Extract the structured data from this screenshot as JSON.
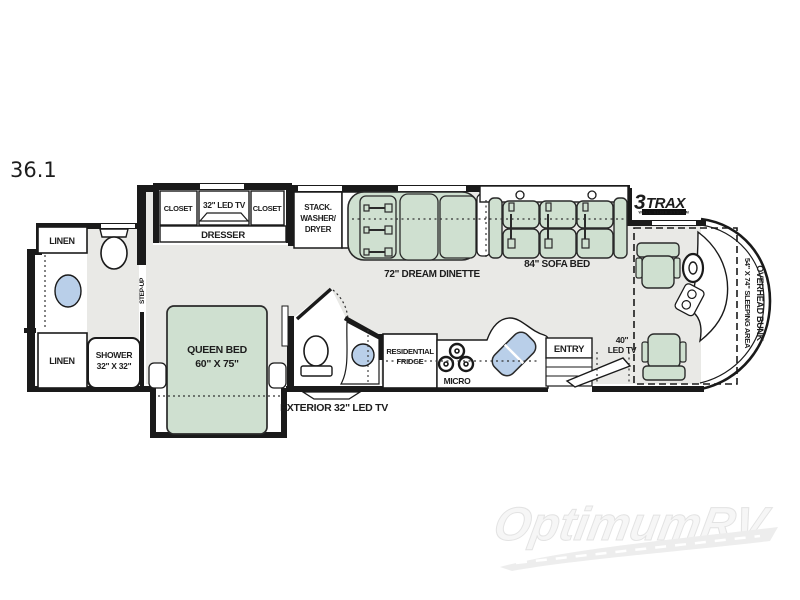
{
  "model": "36.1",
  "brand_logo": {
    "prefix": "3",
    "name": "TRAX",
    "tagline": "WALL SLIDE SYSTEM",
    "blue": "#1b9cd8",
    "dark": "#0d2b4a"
  },
  "watermark": "OptimumRV",
  "labels": {
    "linen_top": "LINEN",
    "linen_bottom": "LINEN",
    "step_up": "STEP-UP",
    "shower": "SHOWER",
    "shower_size": "32\" X 32\"",
    "closet_left": "CLOSET",
    "closet_right": "CLOSET",
    "bedroom_tv": "32\" LED TV",
    "dresser": "DRESSER",
    "washer_line1": "STACK.",
    "washer_line2": "WASHER/",
    "washer_line3": "DRYER",
    "pantry": "PANTRY",
    "dinette": "72\" DREAM DINETTE",
    "sofa": "84\" SOFA BED",
    "queen_bed": "QUEEN BED",
    "queen_size": "60\" X 75\"",
    "exterior_tv": "EXTERIOR 32\" LED TV",
    "fridge_line1": "RESIDENTIAL",
    "fridge_line2": "FRIDGE",
    "micro": "MICRO",
    "entry": "ENTRY",
    "tv40_line1": "40\"",
    "tv40_line2": "LED TV",
    "bunk": "OVERHEAD BUNK",
    "bunk_size": "54\" X 74\" SLEEPING AREA"
  },
  "colors": {
    "wall": "#1a1a1a",
    "floor": "#e9e9e6",
    "furniture_green": "#cfe0d0",
    "water_blue": "#b9cfe9",
    "logo_blue": "#1b9cd8",
    "logo_dark": "#0d2b4a",
    "watermark_gray": "#ededed"
  }
}
